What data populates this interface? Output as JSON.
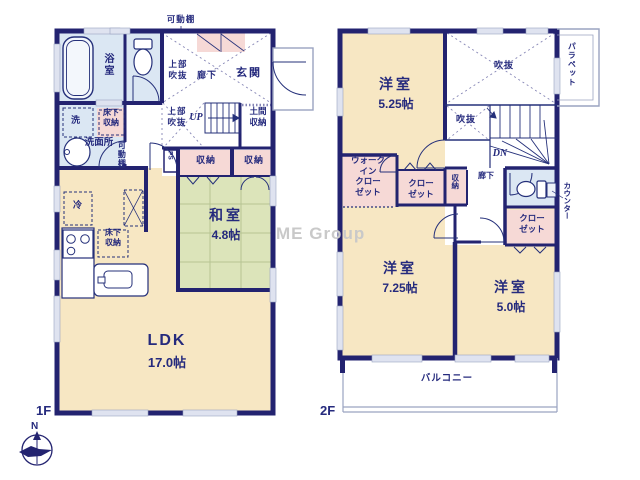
{
  "plan": {
    "watermark": "ME Group",
    "compass": {
      "north": "N"
    },
    "colors": {
      "wall": "#232370",
      "text": "#252a7d",
      "room_cream": "#f7e7c3",
      "wet_area_blue": "#dbe7f3",
      "closet_pink": "#f6d9d6",
      "tatami_green": "#dce4ba",
      "window_gray": "#dfe3f0",
      "watermark_gray": "#c9c9c9"
    },
    "floor1": {
      "floor_label": "1F",
      "labels": {
        "shelf_top": "可動棚",
        "bathroom": "浴室",
        "upper_void_a": "上部\n吹抜",
        "hallway": "廊下",
        "entrance": "玄関",
        "laundry": "洗",
        "underfloor_storage_a": "床下\n収納",
        "washroom": "洗面所",
        "shelf_side": "可動棚",
        "upper_void_b": "上部\n吹抜",
        "stairs_up": "UP",
        "doma_storage": "土間\n収納",
        "pipe_space": "PS",
        "storage_a": "収納",
        "storage_b": "収納",
        "japanese_room": "和室",
        "japanese_room_size": "4.8帖",
        "fridge": "冷",
        "underfloor_storage_b": "床下\n収納",
        "ldk": "LDK",
        "ldk_size": "17.0帖"
      }
    },
    "floor2": {
      "floor_label": "2F",
      "labels": {
        "bedroom_a": "洋室",
        "bedroom_a_size": "5.25帖",
        "void_a": "吹抜",
        "void_b": "吹抜",
        "parapet": "パラペット",
        "stairs_down": "DN",
        "walk_in_closet": "ウォーク\nイン\nクロー\nゼット",
        "closet_a": "クロー\nゼット",
        "storage": "収納",
        "hallway": "廊下",
        "counter": "カウンター",
        "closet_b": "クロー\nゼット",
        "bedroom_b": "洋室",
        "bedroom_b_size": "7.25帖",
        "bedroom_c": "洋室",
        "bedroom_c_size": "5.0帖",
        "balcony": "バルコニー"
      }
    }
  }
}
